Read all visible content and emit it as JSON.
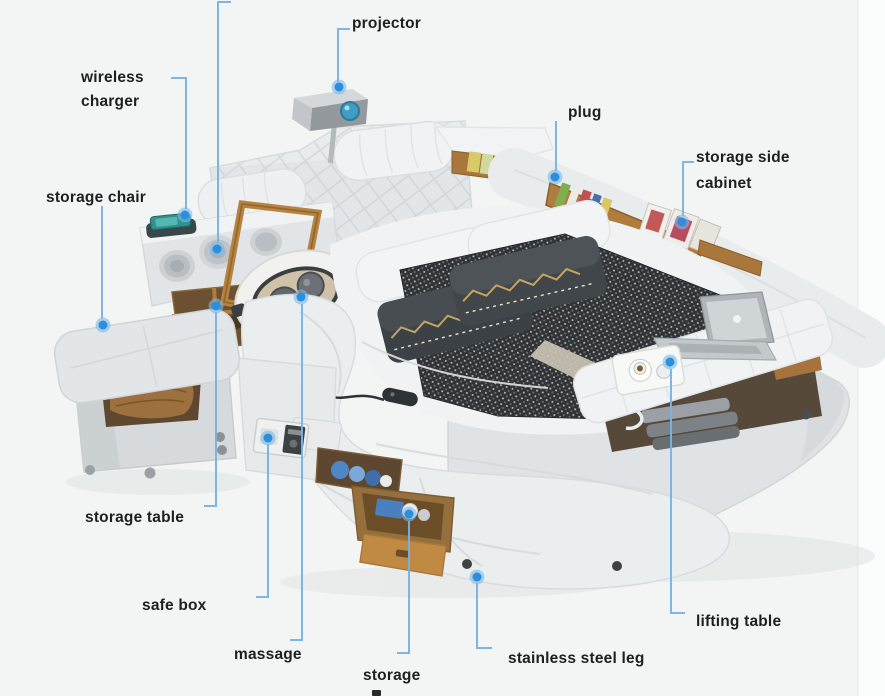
{
  "figure": {
    "kind": "annotated product callout diagram",
    "subject": "multifunctional smart bed photo with feature callouts"
  },
  "colors": {
    "background": "#f3f5f4",
    "callout_line": "#7ab2e0",
    "callout_dot_core": "#2c8fdd",
    "callout_dot_halo": "#7db9e8",
    "label_text": "#1d1f21",
    "bed_leather_light": "#eceff0",
    "bed_leather_mid": "#dde1e3",
    "blanket_dark": "#26292c",
    "wood_tan": "#b07c3e",
    "projector_lens": "#3f9cc4"
  },
  "labels": [
    {
      "id": "projector",
      "text": "projector"
    },
    {
      "id": "wireless-charger",
      "text": "wireless charger"
    },
    {
      "id": "plug",
      "text": "plug"
    },
    {
      "id": "storage-side-cabinet",
      "text": "storage side cabinet"
    },
    {
      "id": "storage-chair",
      "text": "storage chair"
    },
    {
      "id": "storage-table",
      "text": "storage table"
    },
    {
      "id": "safe-box",
      "text": "safe box"
    },
    {
      "id": "massage",
      "text": "massage"
    },
    {
      "id": "storage",
      "text": "storage"
    },
    {
      "id": "stainless-steel-leg",
      "text": "stainless steel leg"
    },
    {
      "id": "lifting-table",
      "text": "lifting table"
    }
  ]
}
